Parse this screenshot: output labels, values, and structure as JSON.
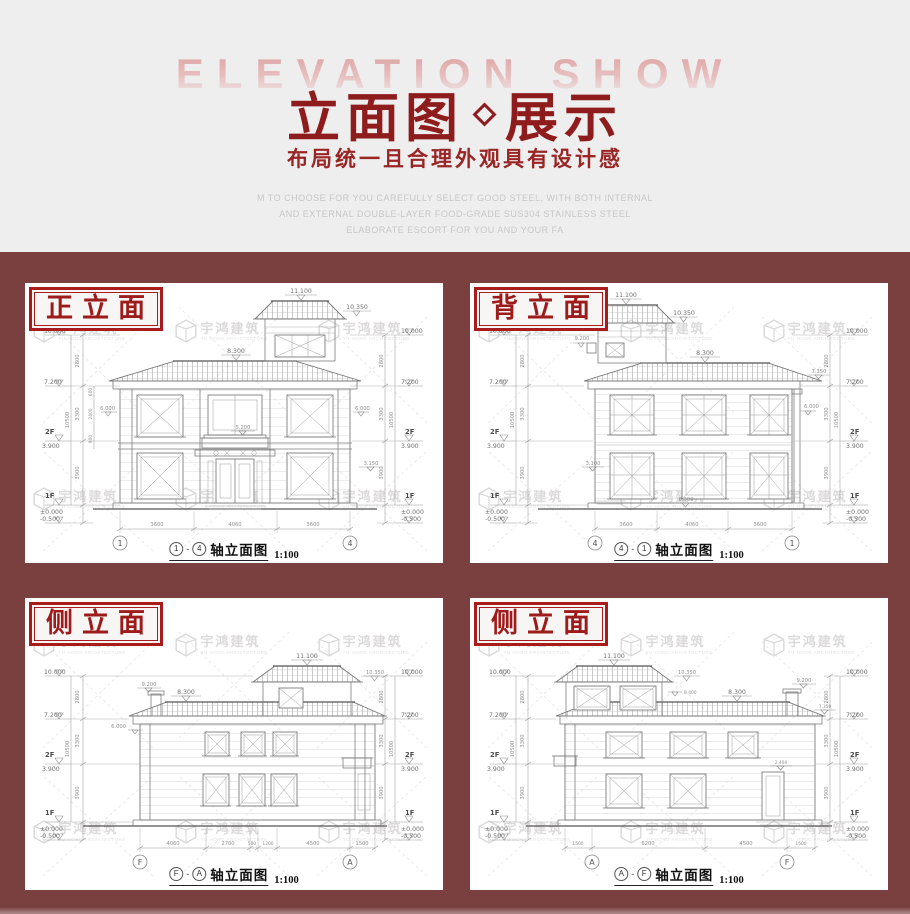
{
  "colors": {
    "background": "#efeeee",
    "maroon": "#7a4040",
    "title_red": "#8e1c1c",
    "label_red": "#a81c1c"
  },
  "header": {
    "watermark_title": "ELEVATION SHOW",
    "title_main": "立面图",
    "title_tail": "展示",
    "subtitle": "布局统一且合理外观具有设计感",
    "desc_line1": "M TO CHOOSE FOR YOU CAREFULLY SELECT GOOD STEEL, WITH BOTH INTERNAL",
    "desc_line2": "AND EXTERNAL DOUBLE-LAYER FOOD-GRADE SUS304 STAINLESS STEEL",
    "desc_line3": "ELABORATE ESCORT FOR YOU AND YOUR FA"
  },
  "watermark": {
    "cn": "宇鸿建筑",
    "en": "YU HONG ARCHITECTURE"
  },
  "panels": [
    {
      "label": "正立面",
      "caption_text": "轴立面图",
      "scale": "1:100",
      "sep": "-",
      "axis_left": "1",
      "axis_right": "4",
      "dims_bottom": [
        "3600",
        "4060",
        "3600"
      ],
      "dims_side": [
        "2800",
        "3300",
        "3900"
      ],
      "dim_total": "10500",
      "dims_inner": [
        "600",
        "2400",
        "900"
      ],
      "levels": {
        "top": "10.000",
        "eave": "7.200",
        "f2": "3.900",
        "f1": "±0.000",
        "ground": "-0.500",
        "peak": "11.100",
        "tower_eave": "10.350",
        "ridge": "8.300",
        "wall": "6.000",
        "balcony": "5.200",
        "side": "3.150"
      },
      "floors": {
        "f2": "2F",
        "f1": "1F"
      }
    },
    {
      "label": "背立面",
      "caption_text": "轴立面图",
      "scale": "1:100",
      "sep": "-",
      "axis_left": "4",
      "axis_right": "1",
      "dims_bottom": [
        "3600",
        "4060",
        "3600"
      ],
      "dims_side": [
        "2800",
        "3300",
        "3900"
      ],
      "dim_total": "10500",
      "levels": {
        "top": "10.000",
        "eave": "7.200",
        "f2": "3.900",
        "f1": "±0.000",
        "ground": "-0.500",
        "peak": "11.100",
        "tower_eave": "10.350",
        "chimney": "9.200",
        "ridge": "8.300",
        "eave2": "7.350",
        "wall": "6.000",
        "porch": "3.100",
        "plinth": "0.300"
      },
      "floors": {
        "f2": "2F",
        "f1": "1F"
      }
    },
    {
      "label": "侧立面",
      "caption_text": "轴立面图",
      "scale": "1:100",
      "sep": "-",
      "axis_left": "F",
      "axis_right": "A",
      "dims_bottom": [
        "4060",
        "2700",
        "500",
        "1200",
        "4500",
        "1500"
      ],
      "dims_side": [
        "2800",
        "3300",
        "3900"
      ],
      "dim_total": "10500",
      "levels": {
        "top": "10.000",
        "eave": "7.200",
        "f2": "3.900",
        "f1": "±0.000",
        "ground": "-0.500",
        "peak": "11.100",
        "tower_eave": "10.350",
        "chimney": "9.200",
        "ridge": "8.300",
        "wall": "6.000"
      },
      "floors": {
        "f2": "2F",
        "f1": "1F"
      }
    },
    {
      "label": "侧立面",
      "caption_text": "轴立面图",
      "scale": "1:100",
      "sep": "-",
      "axis_left": "A",
      "axis_right": "F",
      "dims_bottom": [
        "1500",
        "6200",
        "4500",
        "1500"
      ],
      "dims_side": [
        "2800",
        "3300",
        "3900"
      ],
      "dim_total": "10500",
      "levels": {
        "top": "10.000",
        "eave": "7.200",
        "f2": "3.900",
        "f1": "±0.000",
        "ground": "-0.500",
        "peak": "11.100",
        "tower_eave": "10.350",
        "chimney": "9.200",
        "ridge": "8.300",
        "eave2": "7.350",
        "mid": "8.400",
        "door": "2.400"
      },
      "floors": {
        "f2": "2F",
        "f1": "1F"
      }
    }
  ]
}
